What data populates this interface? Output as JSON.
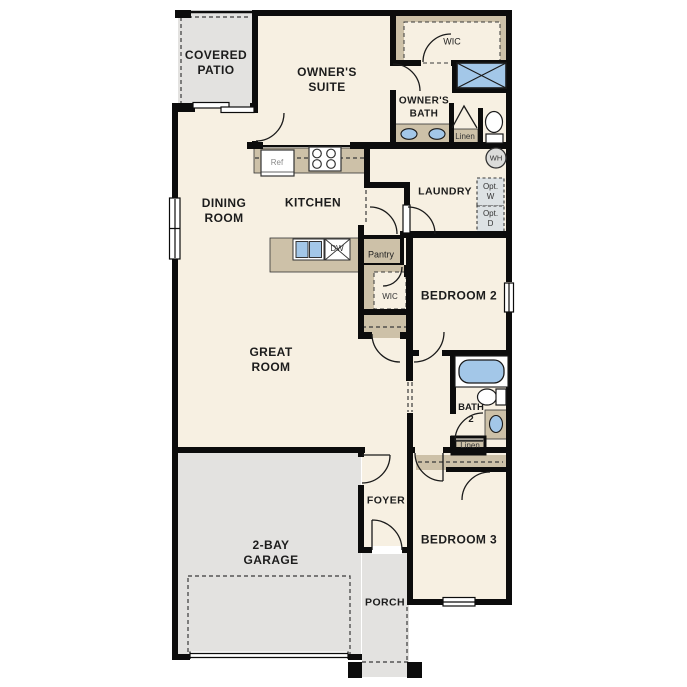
{
  "plan_title": "single-story floor plan",
  "colors": {
    "wall": "#0c0c0c",
    "interior_floor": "#f7f0e2",
    "outdoor_concrete": "#e3e2e0",
    "cabinetry_tan": "#cdc1a8",
    "fixture_blue": "#a3c7e8",
    "optional_appliance_fill": "#dde2e4",
    "background": "#ffffff"
  },
  "labels": {
    "covered_patio": "COVERED\nPATIO",
    "owners_suite": "OWNER'S\nSUITE",
    "wic_owner": "WIC",
    "owners_bath": "OWNER'S\nBATH",
    "linen_owner": "Linen",
    "wh": "WH",
    "laundry": "LAUNDRY",
    "opt_w": "Opt.\nW",
    "opt_d": "Opt.\nD",
    "dining_room": "DINING\nROOM",
    "kitchen": "KITCHEN",
    "ref": "Ref",
    "dw": "DW",
    "pantry": "Pantry",
    "wic_hall": "WIC",
    "bedroom2": "BEDROOM 2",
    "great_room": "GREAT\nROOM",
    "bath2": "BATH\n2",
    "linen_bath2": "Linen",
    "foyer": "FOYER",
    "bedroom3": "BEDROOM 3",
    "garage": "2-BAY\nGARAGE",
    "porch": "PORCH"
  },
  "fixtures": [
    "refrigerator",
    "range-4-burner",
    "island-double-sink",
    "dishwasher",
    "walk-in-shower",
    "owner-vanity-double-sinks",
    "toilet-owner-bath",
    "water-heater",
    "optional-washer",
    "optional-dryer",
    "bathtub",
    "toilet-bath2",
    "sink-bath2",
    "garage-door",
    "front-door"
  ]
}
